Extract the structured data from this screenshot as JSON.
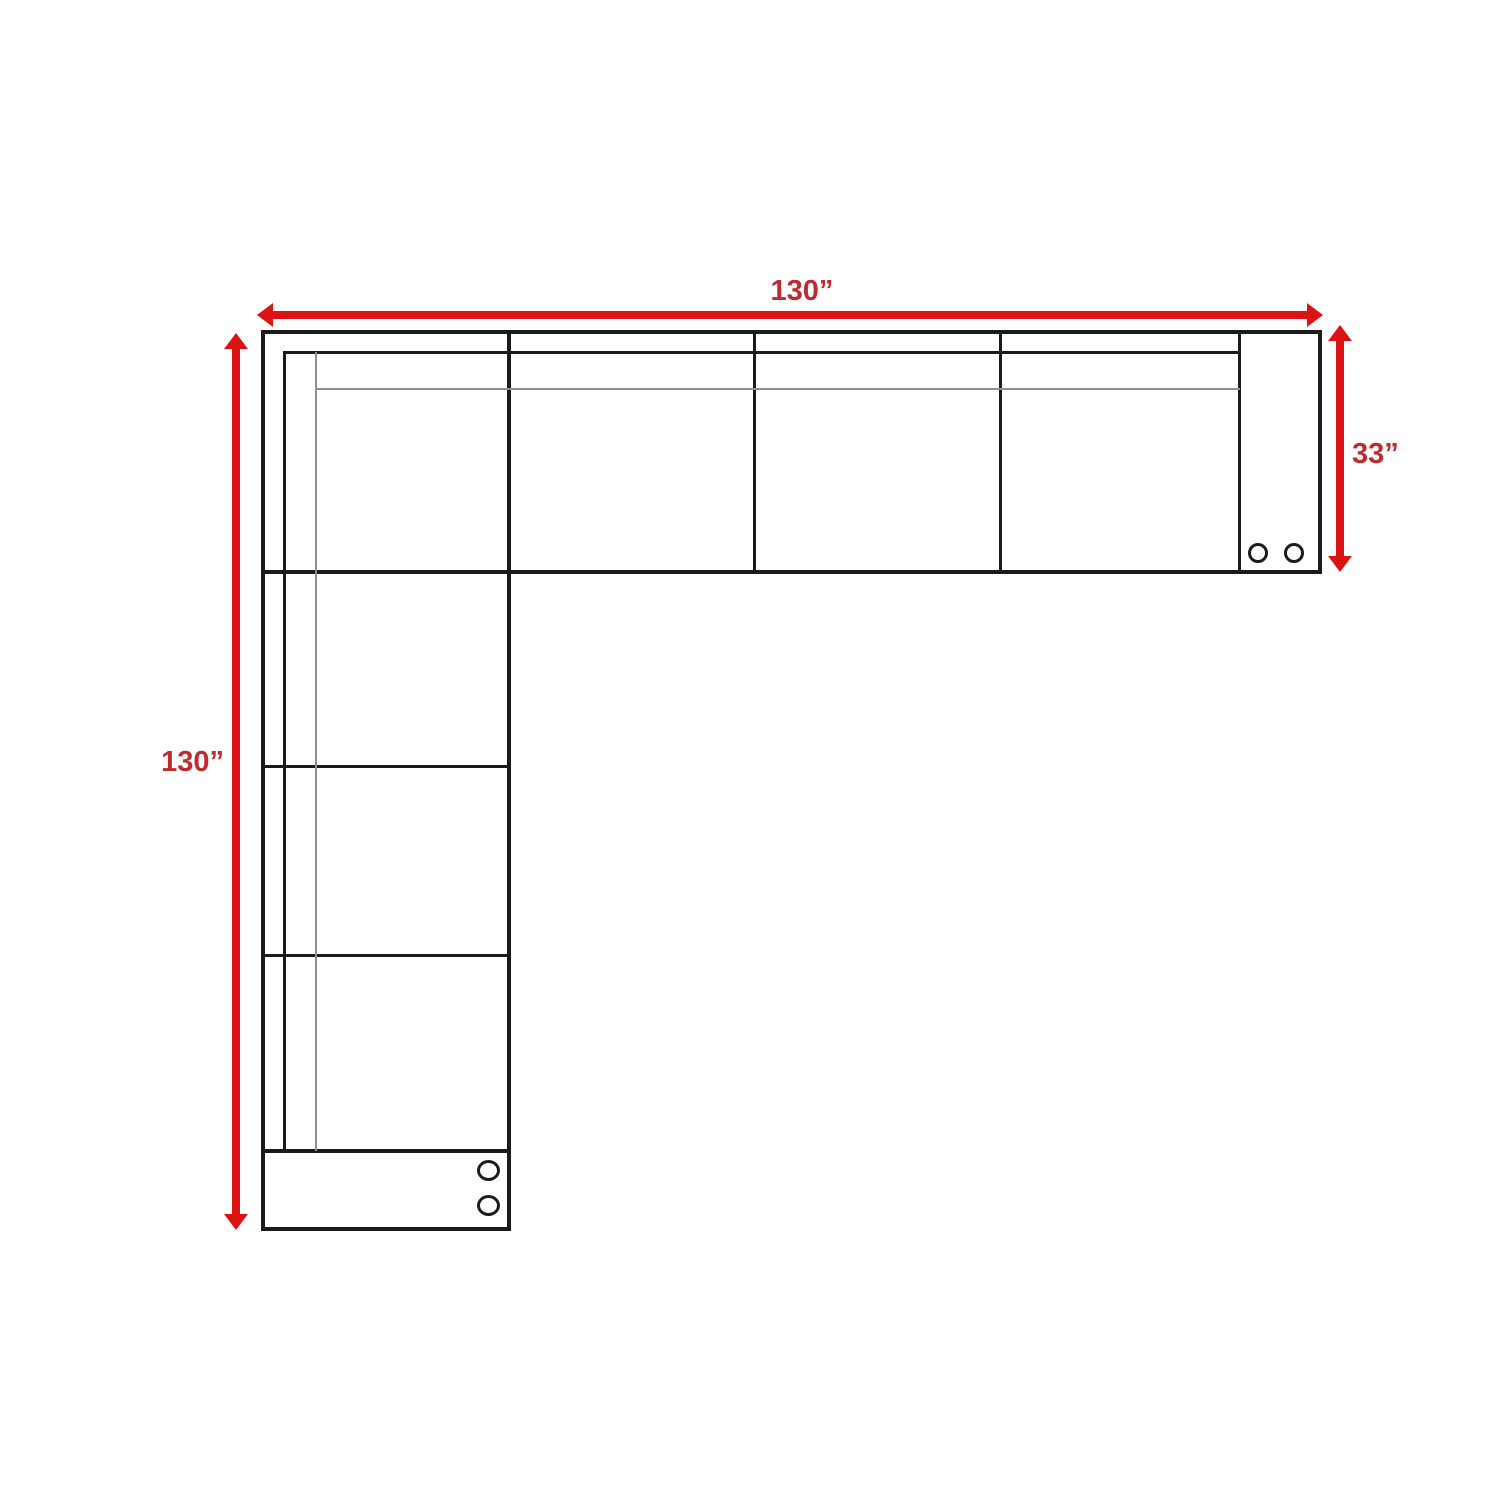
{
  "diagram": {
    "kind": "sectional-sofa-floor-plan",
    "dimension_labels": {
      "top": "130”",
      "left": "130”",
      "right": "33”"
    },
    "colors": {
      "arrow_red": "#dc1315",
      "label_red": "#bf2a2e",
      "line_black": "#1b1b1b",
      "thin_gray": "#8f8f8f",
      "background": "#ffffff"
    }
  }
}
